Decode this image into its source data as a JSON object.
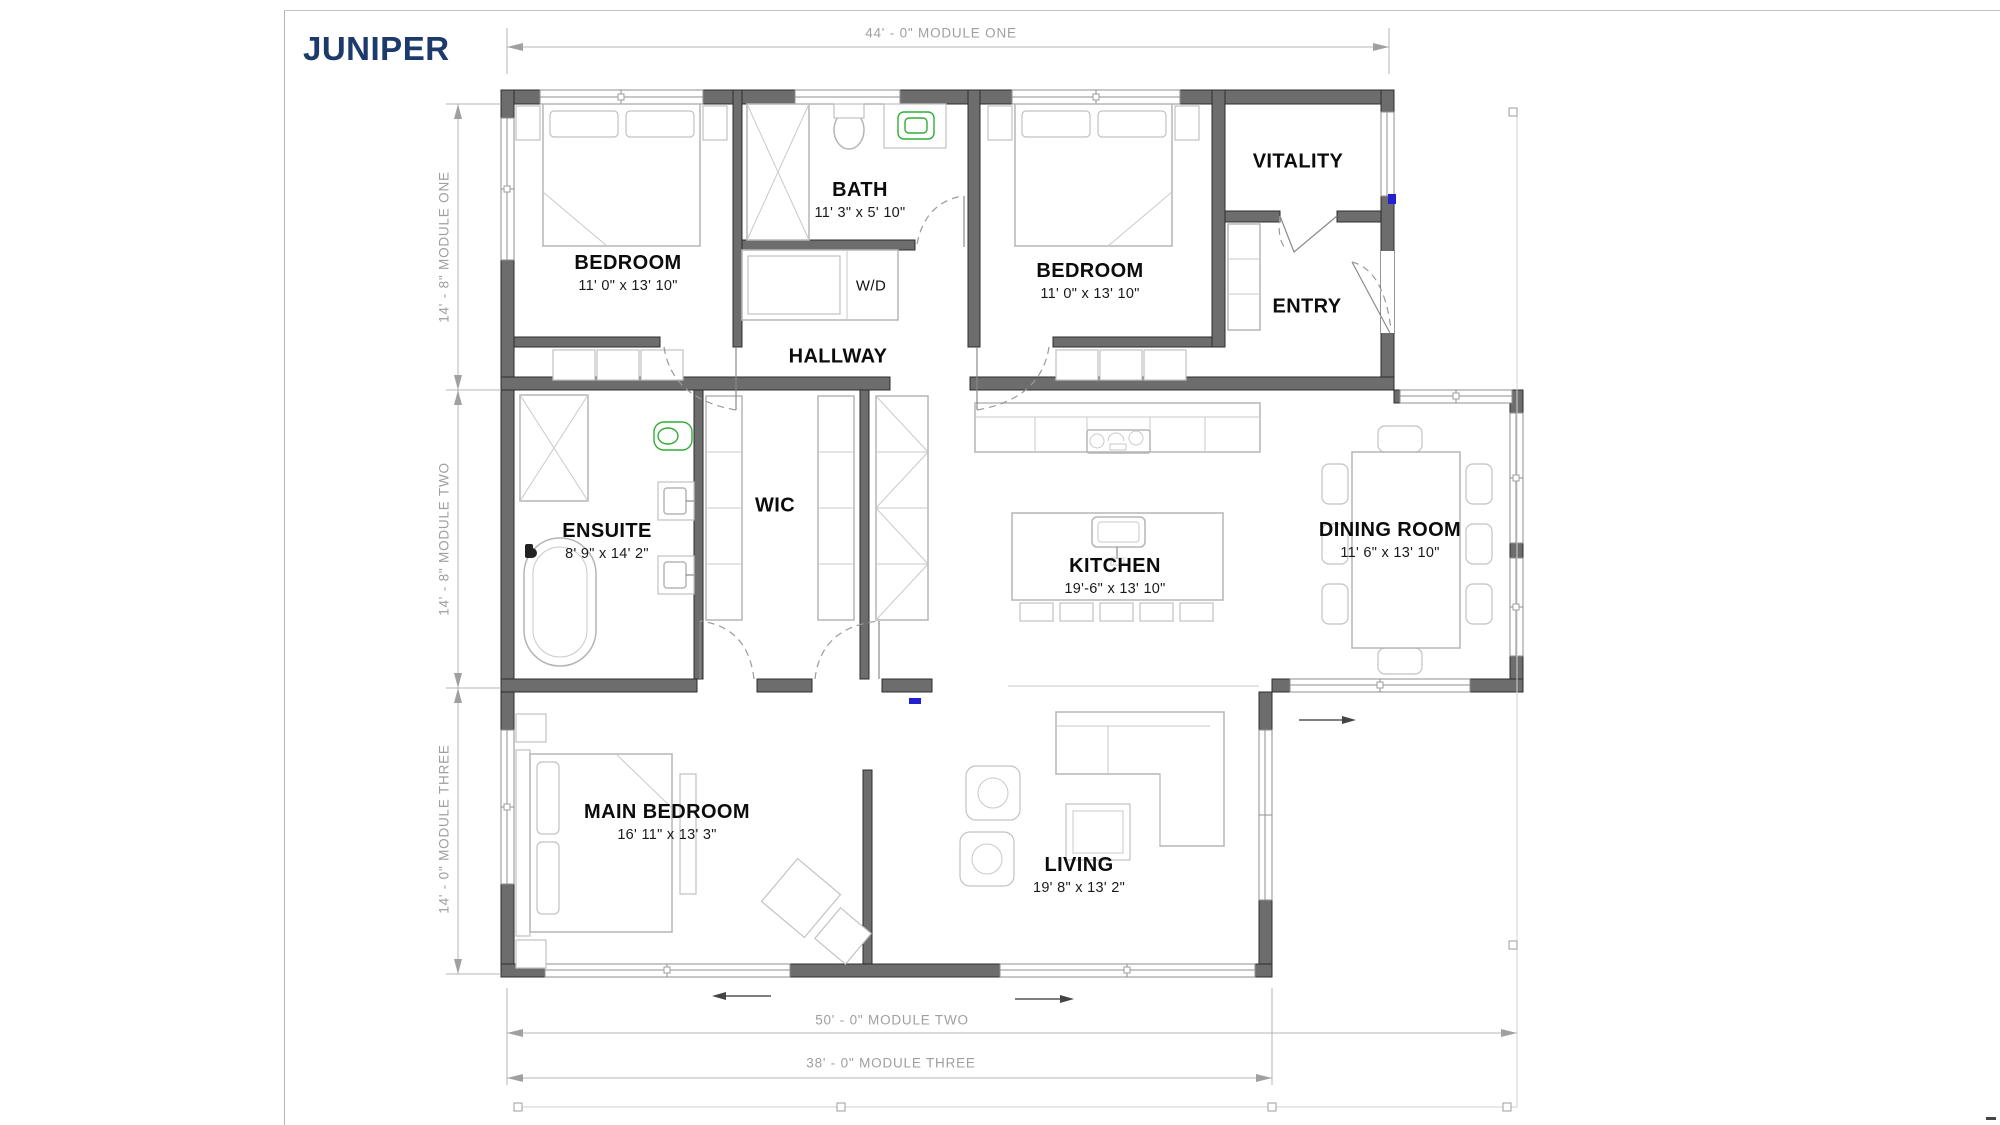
{
  "title": "JUNIPER",
  "annotations": {
    "module_one_width": "44' - 0\" MODULE ONE",
    "module_one_height": "14' - 8\" MODULE ONE",
    "module_two_height": "14' - 8\" MODULE TWO",
    "module_three_height": "14' - 0\" MODULE THREE",
    "module_two_width": "50' - 0\" MODULE TWO",
    "module_three_width": "38' - 0\" MODULE THREE"
  },
  "rooms": {
    "bedroom_left": {
      "label": "BEDROOM",
      "size": "11' 0\" x 13' 10\""
    },
    "bath": {
      "label": "BATH",
      "size": "11' 3\" x 5' 10\""
    },
    "laundry": {
      "label": "W/D"
    },
    "hallway": {
      "label": "HALLWAY"
    },
    "bedroom_right": {
      "label": "BEDROOM",
      "size": "11' 0\" x 13' 10\""
    },
    "vitality": {
      "label": "VITALITY"
    },
    "entry": {
      "label": "ENTRY"
    },
    "ensuite": {
      "label": "ENSUITE",
      "size": "8' 9\" x 14' 2\""
    },
    "wic": {
      "label": "WIC"
    },
    "kitchen": {
      "label": "KITCHEN",
      "size": "19'-6\" x 13' 10\""
    },
    "dining": {
      "label": "DINING ROOM",
      "size": "11' 6\" x 13' 10\""
    },
    "main_bedroom": {
      "label": "MAIN BEDROOM",
      "size": "16' 11\" x 13' 3\""
    },
    "living": {
      "label": "LIVING",
      "size": "19' 8\" x 13' 2\""
    }
  },
  "colors": {
    "title": "#1d3a6c",
    "wall": "#6d6d6d",
    "dimension": "#9f9f9f",
    "fixture_green": "#2fae35",
    "marker_blue": "#2121d2"
  }
}
